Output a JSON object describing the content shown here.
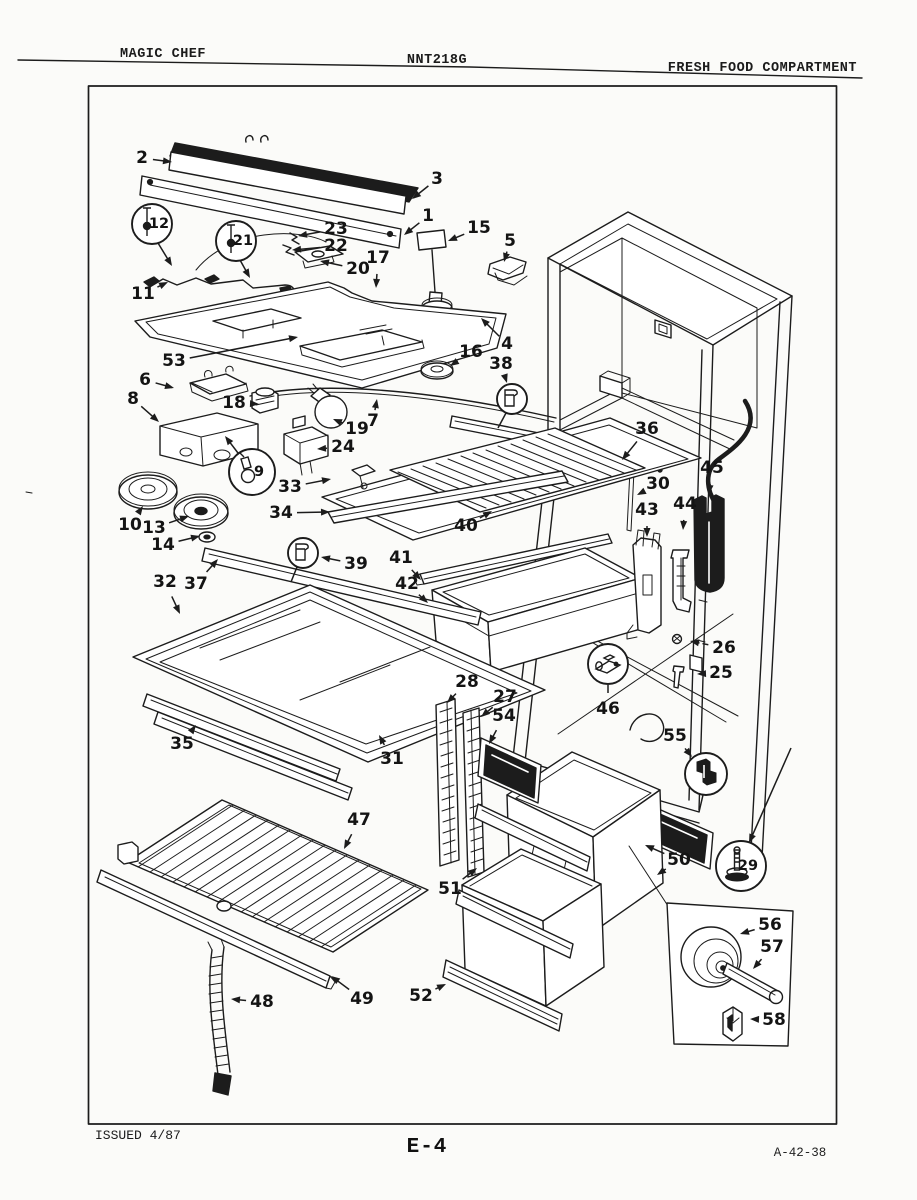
{
  "header": {
    "left": "MAGIC CHEF",
    "center": "NNT218G",
    "right": "FRESH FOOD COMPARTMENT"
  },
  "footer": {
    "left": "ISSUED 4/87",
    "center": "E-4",
    "right": "A-42-38"
  },
  "diagram": {
    "ink": "#1c1c1c",
    "paper": "#fbfbf9",
    "callouts": [
      {
        "n": "2",
        "x": 142,
        "y": 158,
        "tips": [
          [
            172,
            162
          ]
        ]
      },
      {
        "n": "3",
        "x": 437,
        "y": 179,
        "tips": [
          [
            412,
            199
          ]
        ]
      },
      {
        "n": "1",
        "x": 428,
        "y": 216,
        "tips": [
          [
            404,
            235
          ]
        ]
      },
      {
        "n": "12",
        "balloon": {
          "cx": 152,
          "cy": 224,
          "r": 20,
          "glyph": "pin",
          "num": true,
          "tail": [
            158,
            243,
            172,
            266
          ],
          "tailArrow": true
        }
      },
      {
        "n": "21",
        "balloon": {
          "cx": 236,
          "cy": 241,
          "r": 20,
          "glyph": "pin",
          "num": true,
          "tail": [
            240,
            260,
            250,
            278
          ],
          "tailArrow": true
        }
      },
      {
        "n": "23",
        "x": 336,
        "y": 229,
        "tips": [
          [
            298,
            236
          ]
        ]
      },
      {
        "n": "22",
        "x": 336,
        "y": 246,
        "tips": [
          [
            292,
            250
          ]
        ]
      },
      {
        "n": "15",
        "x": 479,
        "y": 228,
        "tips": [
          [
            448,
            241
          ]
        ]
      },
      {
        "n": "5",
        "x": 510,
        "y": 241,
        "tips": [
          [
            504,
            262
          ]
        ]
      },
      {
        "n": "20",
        "x": 358,
        "y": 269,
        "tips": [
          [
            320,
            261
          ]
        ]
      },
      {
        "n": "17",
        "x": 378,
        "y": 258,
        "tips": [
          [
            376,
            288
          ]
        ]
      },
      {
        "n": "11",
        "x": 143,
        "y": 294,
        "tips": [
          [
            168,
            282
          ]
        ]
      },
      {
        "n": "53",
        "x": 174,
        "y": 361,
        "tips": [
          [
            298,
            337
          ]
        ]
      },
      {
        "n": "4",
        "x": 507,
        "y": 344,
        "tips": [
          [
            481,
            318
          ]
        ]
      },
      {
        "n": "16",
        "x": 471,
        "y": 352,
        "tips": [
          [
            450,
            366
          ]
        ]
      },
      {
        "n": "38",
        "x": 501,
        "y": 364,
        "tips": [
          [
            507,
            383
          ]
        ],
        "balloon": {
          "cx": 512,
          "cy": 399,
          "r": 15,
          "glyph": "clip",
          "num": false,
          "tail": [
            506,
            413,
            498,
            428
          ]
        }
      },
      {
        "n": "6",
        "x": 145,
        "y": 380,
        "tips": [
          [
            174,
            388
          ]
        ]
      },
      {
        "n": "8",
        "x": 133,
        "y": 399,
        "tips": [
          [
            159,
            422
          ]
        ]
      },
      {
        "n": "18",
        "x": 234,
        "y": 403,
        "tips": [
          [
            259,
            404
          ]
        ]
      },
      {
        "n": "19",
        "x": 357,
        "y": 429,
        "tips": [
          [
            333,
            419
          ]
        ]
      },
      {
        "n": "7",
        "x": 373,
        "y": 421,
        "tips": [
          [
            377,
            399
          ]
        ]
      },
      {
        "n": "24",
        "x": 343,
        "y": 447,
        "tips": [
          [
            317,
            449
          ]
        ]
      },
      {
        "n": "9",
        "balloon": {
          "cx": 252,
          "cy": 472,
          "r": 23,
          "glyph": "bulb",
          "num": true,
          "tail": [
            238,
            453,
            225,
            436
          ],
          "tailArrow": true
        }
      },
      {
        "n": "10",
        "x": 130,
        "y": 525,
        "tips": [
          [
            143,
            506
          ]
        ]
      },
      {
        "n": "13",
        "x": 154,
        "y": 528,
        "tips": [
          [
            189,
            516
          ]
        ]
      },
      {
        "n": "14",
        "x": 163,
        "y": 545,
        "tips": [
          [
            200,
            536
          ]
        ]
      },
      {
        "n": "33",
        "x": 290,
        "y": 487,
        "tips": [
          [
            331,
            479
          ]
        ]
      },
      {
        "n": "34",
        "x": 281,
        "y": 513,
        "tips": [
          [
            330,
            512
          ]
        ]
      },
      {
        "n": "40",
        "x": 466,
        "y": 526,
        "tips": [
          [
            492,
            511
          ]
        ]
      },
      {
        "n": "36",
        "x": 647,
        "y": 429,
        "tips": [
          [
            622,
            460
          ]
        ]
      },
      {
        "n": "30",
        "x": 658,
        "y": 484,
        "tips": [
          [
            637,
            495
          ]
        ]
      },
      {
        "n": "45",
        "x": 712,
        "y": 468,
        "tips": [
          [
            709,
            494
          ]
        ]
      },
      {
        "n": "44",
        "x": 685,
        "y": 504,
        "tips": [
          [
            683,
            530
          ]
        ]
      },
      {
        "n": "43",
        "x": 647,
        "y": 510,
        "tips": [
          [
            647,
            537
          ]
        ]
      },
      {
        "n": "39",
        "x": 356,
        "y": 564,
        "tips": [
          [
            321,
            557
          ]
        ],
        "balloon": {
          "cx": 303,
          "cy": 553,
          "r": 15,
          "glyph": "clip",
          "num": false,
          "tail": [
            297,
            567,
            291,
            582
          ]
        }
      },
      {
        "n": "41",
        "x": 401,
        "y": 558,
        "tips": [
          [
            421,
            580
          ]
        ]
      },
      {
        "n": "42",
        "x": 407,
        "y": 584,
        "tips": [
          [
            428,
            603
          ]
        ]
      },
      {
        "n": "32",
        "x": 165,
        "y": 582,
        "tips": [
          [
            180,
            614
          ]
        ]
      },
      {
        "n": "37",
        "x": 196,
        "y": 584,
        "tips": [
          [
            218,
            559
          ]
        ]
      },
      {
        "n": "26",
        "x": 724,
        "y": 648,
        "dash": true,
        "tips": [
          [
            690,
            641
          ]
        ]
      },
      {
        "n": "25",
        "x": 721,
        "y": 673,
        "dash": true,
        "tips": [
          [
            697,
            674
          ]
        ]
      },
      {
        "n": "46",
        "x": 608,
        "y": 709,
        "plain": true,
        "tips": [
          [
            608,
            685
          ]
        ],
        "balloon": {
          "cx": 608,
          "cy": 664,
          "r": 20,
          "glyph": "axle",
          "num": false
        }
      },
      {
        "n": "28",
        "x": 467,
        "y": 682,
        "tips": [
          [
            447,
            703
          ]
        ]
      },
      {
        "n": "27",
        "x": 505,
        "y": 697,
        "tips": [
          [
            481,
            717
          ]
        ]
      },
      {
        "n": "54",
        "x": 504,
        "y": 716,
        "tips": [
          [
            489,
            744
          ]
        ]
      },
      {
        "n": "55",
        "x": 675,
        "y": 736,
        "tips": [
          [
            692,
            757
          ]
        ],
        "balloon": {
          "cx": 706,
          "cy": 774,
          "r": 21,
          "glyph": "bracket",
          "num": false,
          "tail": [
            703,
            795,
            699,
            812
          ]
        }
      },
      {
        "n": "35",
        "x": 182,
        "y": 744,
        "tips": [
          [
            196,
            725
          ]
        ]
      },
      {
        "n": "31",
        "x": 392,
        "y": 759,
        "tips": [
          [
            379,
            735
          ]
        ]
      },
      {
        "n": "29",
        "balloon": {
          "cx": 741,
          "cy": 866,
          "r": 25,
          "glyph": "leg",
          "num": true,
          "tail": [
            791,
            748,
            749,
            843
          ],
          "tailArrow": true
        }
      },
      {
        "n": "47",
        "x": 359,
        "y": 820,
        "tips": [
          [
            344,
            849
          ]
        ]
      },
      {
        "n": "50",
        "x": 679,
        "y": 860,
        "tips": [
          [
            645,
            845
          ],
          [
            657,
            875
          ]
        ]
      },
      {
        "n": "51",
        "x": 450,
        "y": 889,
        "tips": [
          [
            477,
            868
          ]
        ]
      },
      {
        "n": "52",
        "x": 421,
        "y": 996,
        "tips": [
          [
            446,
            984
          ]
        ]
      },
      {
        "n": "48",
        "x": 262,
        "y": 1002,
        "tips": [
          [
            231,
            999
          ]
        ]
      },
      {
        "n": "49",
        "x": 362,
        "y": 999,
        "tips": [
          [
            331,
            976
          ]
        ]
      },
      {
        "n": "56",
        "x": 770,
        "y": 925,
        "tips": [
          [
            740,
            934
          ]
        ]
      },
      {
        "n": "57",
        "x": 772,
        "y": 947,
        "tips": [
          [
            753,
            969
          ]
        ]
      },
      {
        "n": "58",
        "x": 774,
        "y": 1020,
        "dash": true,
        "tips": [
          [
            750,
            1019
          ]
        ]
      }
    ]
  }
}
